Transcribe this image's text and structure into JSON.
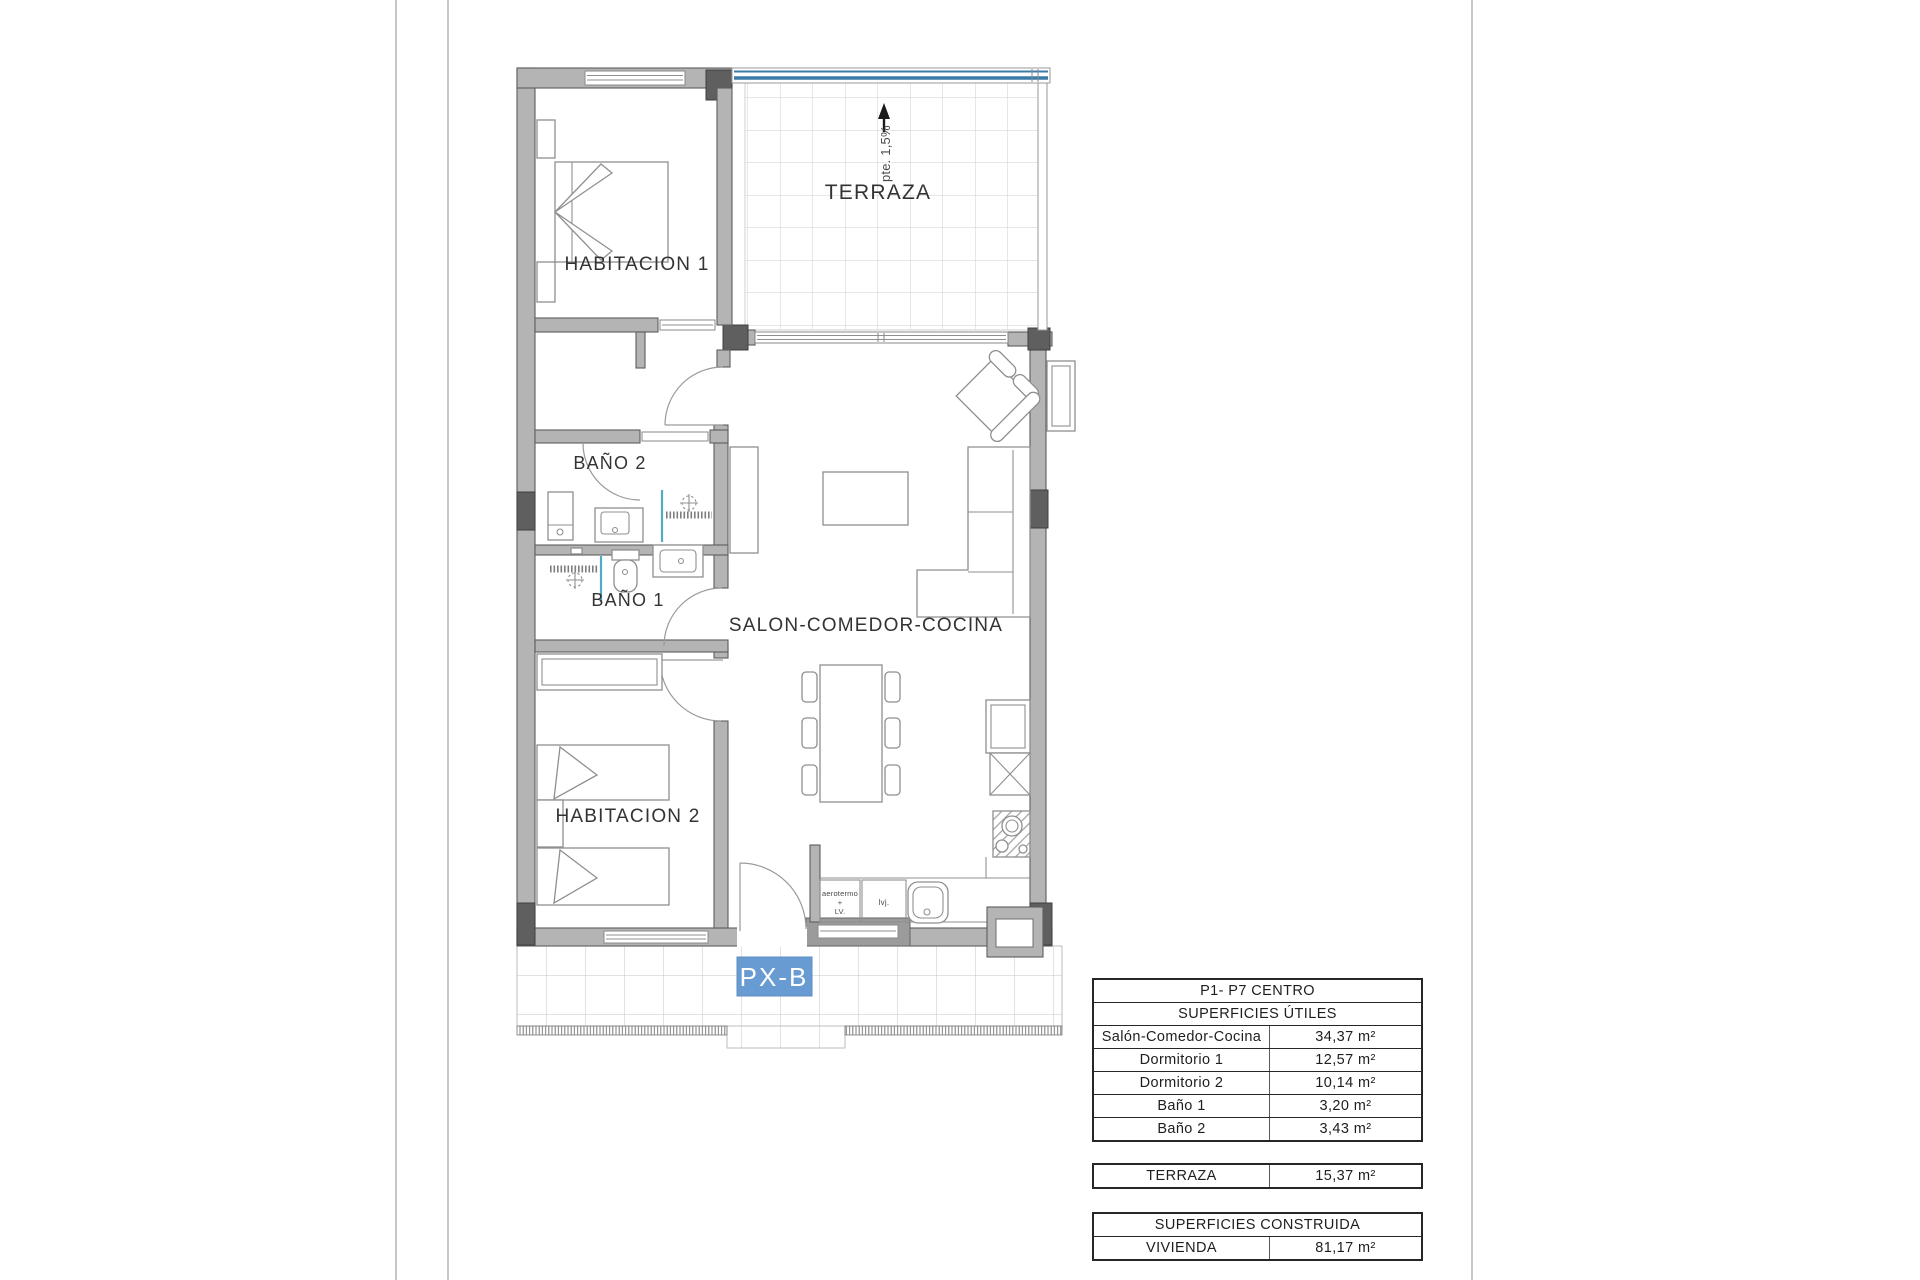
{
  "plan": {
    "labels": {
      "habitacion1": "HABITACION 1",
      "habitacion2": "HABITACION 2",
      "bano1": "BAÑO 1",
      "bano2": "BAÑO 2",
      "salon": "SALON-COMEDOR-COCINA",
      "terraza": "TERRAZA",
      "slope": "pte. 1,5%",
      "unit": "PX-B",
      "kitchen_appliance_line1": "aerotermo",
      "kitchen_appliance_line2": "+",
      "kitchen_appliance_line3": "LV.",
      "kitchen_appliance2": "lvj."
    },
    "colors": {
      "wall": "#b4b4b4",
      "pillar": "#5f5f5f",
      "terraza_blue": "#3a7ca8",
      "shower_glass": "#53aac6",
      "unit_badge": "#699bd3"
    }
  },
  "tables": {
    "useful": {
      "title": "P1- P7 CENTRO",
      "subtitle": "SUPERFICIES ÚTILES",
      "rows": [
        {
          "label": "Salón-Comedor-Cocina",
          "value": "34,37 m²"
        },
        {
          "label": "Dormitorio 1",
          "value": "12,57 m²"
        },
        {
          "label": "Dormitorio 2",
          "value": "10,14 m²"
        },
        {
          "label": "Baño 1",
          "value": "3,20 m²"
        },
        {
          "label": "Baño 2",
          "value": "3,43 m²"
        }
      ]
    },
    "terraza_row": {
      "label": "TERRAZA",
      "value": "15,37 m²"
    },
    "built": {
      "title": "SUPERFICIES CONSTRUIDA",
      "rows": [
        {
          "label": "VIVIENDA",
          "value": "81,17 m²"
        }
      ]
    }
  }
}
